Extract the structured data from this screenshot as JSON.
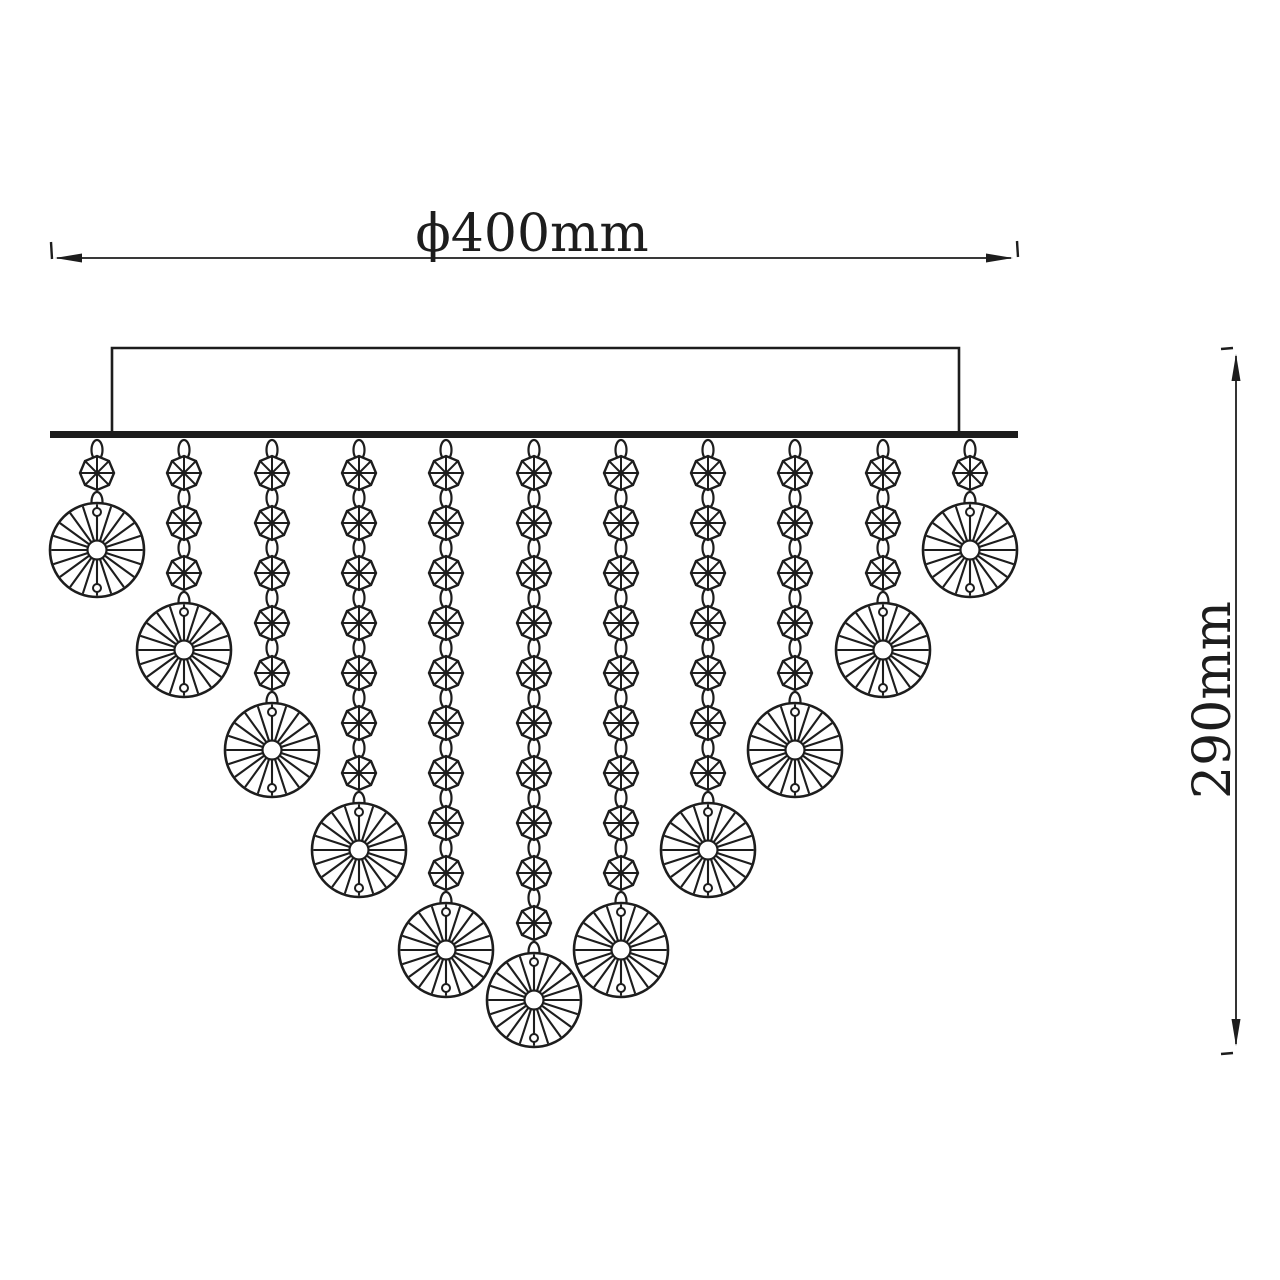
{
  "page": {
    "background_color": "#ffffff",
    "line_color": "#1d1d1d",
    "width": 1280,
    "height": 1280
  },
  "labels": {
    "diameter": "ϕ400mm",
    "height": "290mm"
  },
  "diagram": {
    "type": "technical-dimension-drawing",
    "subject": "crystal-bead ceiling chandelier, front elevation",
    "canopy_box": {
      "x1": 112,
      "y1": 348,
      "x2": 959,
      "y2": 433
    },
    "mounting_plate": {
      "x": 50,
      "y": 431,
      "width": 968,
      "height": 7
    },
    "dimension_lines": {
      "horizontal": {
        "y": 258,
        "x1": 55,
        "x2": 1013,
        "label_x": 532,
        "label_y": 251
      },
      "vertical": {
        "x": 1236,
        "y1": 354,
        "y2": 1046,
        "label_x": 1230,
        "label_y": 700
      }
    },
    "strands": {
      "count": 11,
      "x_positions": [
        97,
        184,
        272,
        359,
        446,
        534,
        621,
        708,
        795,
        883,
        970
      ],
      "bead_counts": [
        1,
        3,
        5,
        7,
        9,
        10,
        9,
        7,
        5,
        3,
        1
      ],
      "first_bead_y": 473,
      "bead_spacing": 50,
      "bead_radius": 17,
      "link_rx": 5.5,
      "link_ry": 10,
      "disc_radius": 47,
      "disc_inner_radius": 9.5,
      "disc_spokes": 20,
      "disc_hole_offset": 38,
      "disc_hole_radius": 4,
      "disc_offset_from_last_bead": 77
    }
  }
}
